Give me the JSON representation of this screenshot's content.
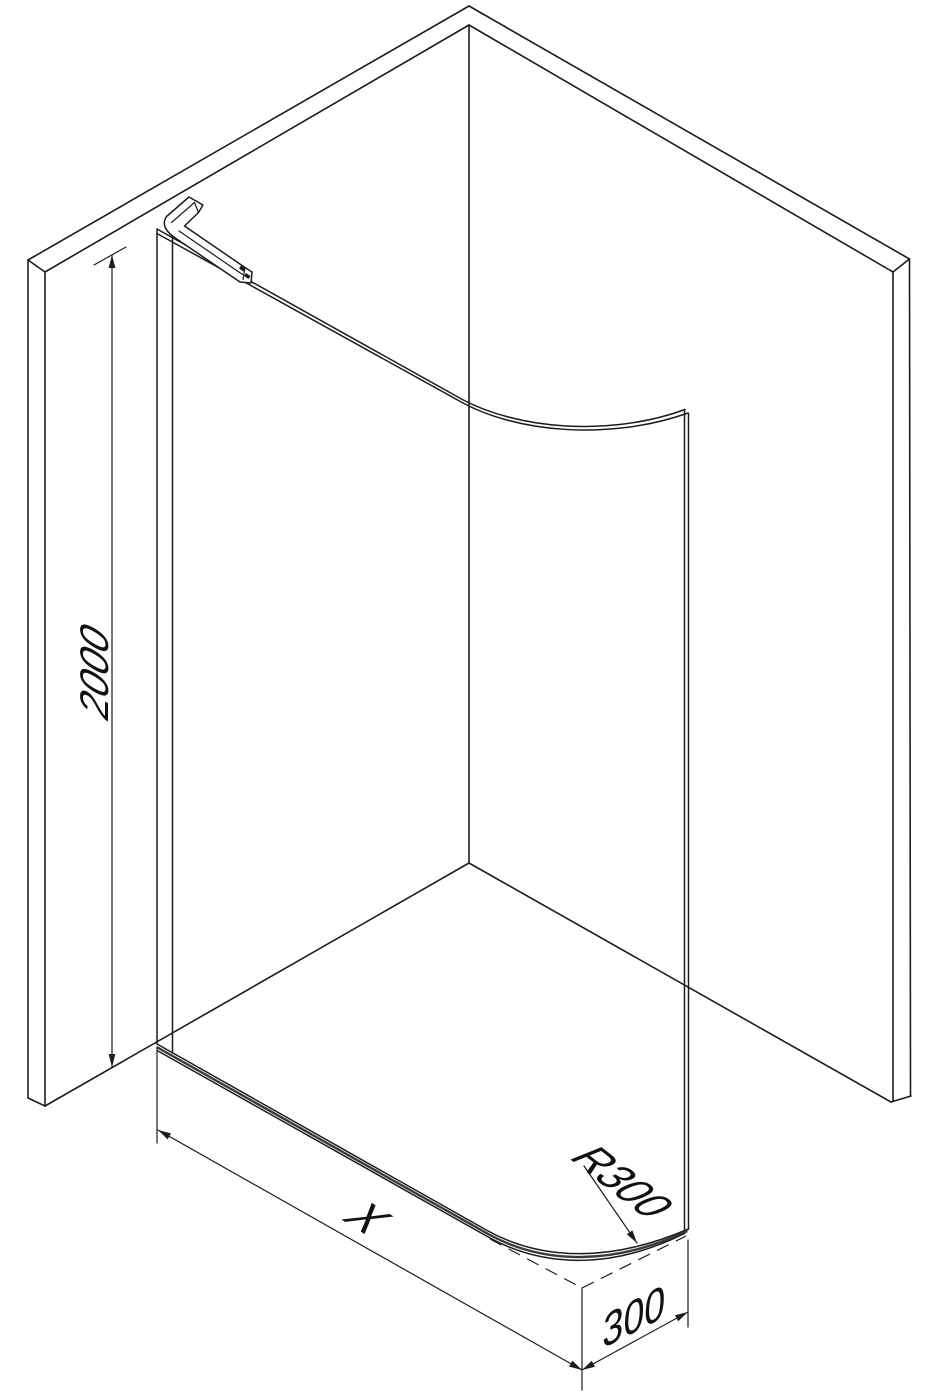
{
  "diagram": {
    "title": "Walk-in shower screen with curved glass panel — isometric technical drawing",
    "type": "isometric-line-drawing",
    "background": "#ffffff",
    "line_color": "#1c1c1c",
    "labels": {
      "height": "2000",
      "width": "X",
      "radius": "R300",
      "depth": "300"
    }
  }
}
